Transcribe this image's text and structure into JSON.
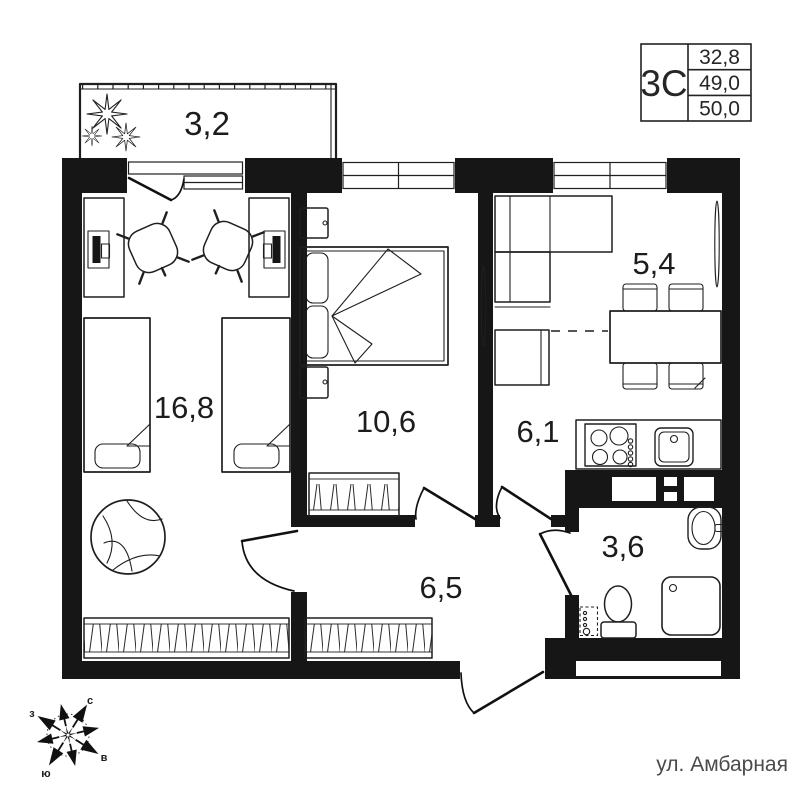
{
  "title_block": {
    "plan_code": "3С",
    "areas": [
      "32,8",
      "49,0",
      "50,0"
    ]
  },
  "room_labels": {
    "balcony": "3,2",
    "bedroom_1": "16,8",
    "bedroom_2": "10,6",
    "hall": "6,1",
    "kitchen_living": "5,4",
    "corridor": "6,5",
    "bathroom": "3,6"
  },
  "compass": {
    "north": "с",
    "east": "в",
    "south": "ю",
    "west": "з"
  },
  "street_label": "ул. Амбарная",
  "colors": {
    "wall": "#161616",
    "line": "#1f1f1f",
    "label": "#1c1c1c",
    "muted_text": "#4b4b4b"
  }
}
